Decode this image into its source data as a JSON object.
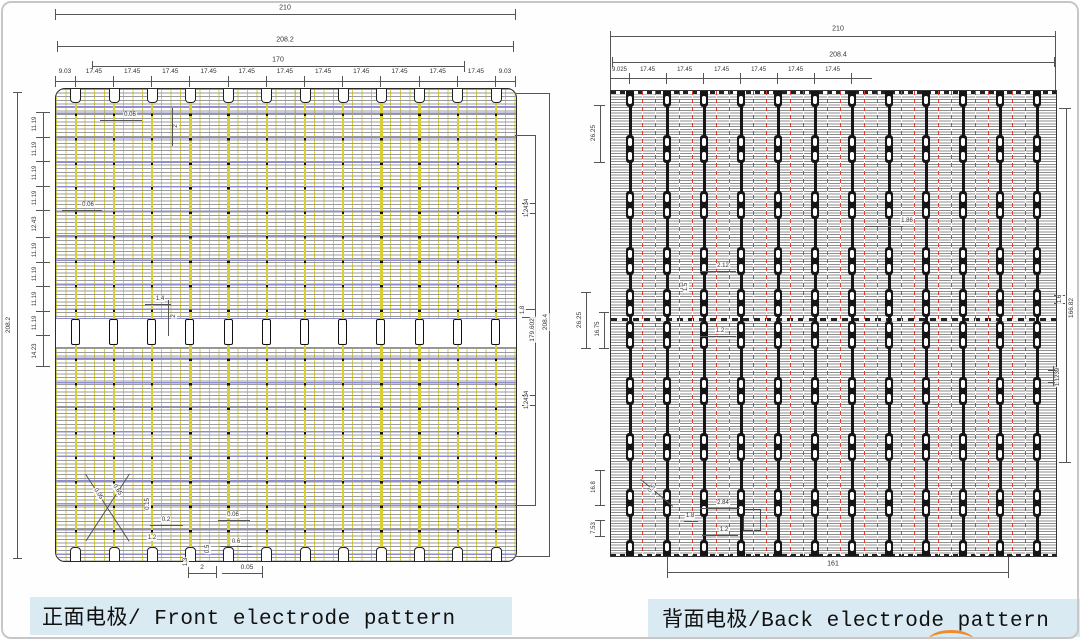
{
  "front": {
    "caption": "正面电极/ Front electrode pattern",
    "overall_width": "210",
    "inner_width": "208.2",
    "busbar_span": "170",
    "segments": [
      "9.03",
      "17.45",
      "17.45",
      "17.45",
      "17.45",
      "17.45",
      "17.45",
      "17.45",
      "17.45",
      "17.45",
      "17.45",
      "17.45",
      "9.03"
    ],
    "height_overall": "208.2",
    "row_chain": [
      "11.19",
      "11.19",
      "11.19",
      "11.19",
      "12.43",
      "11.19",
      "11.19",
      "11.19",
      "11.19",
      "14.23"
    ],
    "right_pad_dim_upper": "1.2434",
    "right_gap_dim": "1.8",
    "right_pad_dim_lower": "1.2434",
    "pad_region_height": "179.602",
    "height_outer": "208.4",
    "finger_width_top": "0.06",
    "finger_width_mid": "0.06",
    "mid_pad_width": "1.4",
    "top_notch_depth": "2",
    "mid_pad_len": "2",
    "bottom_dims": {
      "d015": "0.15",
      "d02": "0.2",
      "d12": "1.2",
      "d05r": "0.5",
      "d006": "0.06",
      "d06": "0.6",
      "d2": "2",
      "d005": "0.05",
      "d13": "1.3",
      "diag1": "0.05",
      "diag2": "0.65"
    }
  },
  "back": {
    "caption": "背面电极/Back electrode pattern",
    "overall_width": "210",
    "inner_width": "208.4",
    "segments": [
      "9.025",
      "17.45",
      "17.45",
      "17.45",
      "17.45",
      "17.45",
      "17.45"
    ],
    "pad_pitch_top": "26.25",
    "pad_pitch_mid": "26.25",
    "pad_gap_mid": "16.75",
    "pad_pitch_bottom": "16.8",
    "edge_gap_bottom": "7.53",
    "right_dims": {
      "d16": "1.6",
      "d16682": "166.82",
      "d11239": "1.1239"
    },
    "bottom_span": "161",
    "interior": {
      "d186": "1.86",
      "d212": "2.12",
      "d15": "1.5",
      "d12a": "1.2",
      "d284": "2.84",
      "d18": "1.8",
      "d12b": "1.2",
      "d05": "0.5"
    }
  },
  "pattern": {
    "front_busbars": 12,
    "back_busbars": 12,
    "back_pad_row_centers": [
      2,
      58,
      114,
      170,
      212,
      244,
      300,
      356,
      412,
      463
    ]
  },
  "colors": {
    "finger_gray": "#9b9b9b",
    "busbar_yellow": "#d9cf30",
    "blue_line": "#8d8dcc",
    "red_centerline": "#e23b2e",
    "caption_bg": "#d9eaf2",
    "stamp_orange": "#ef8b2b"
  }
}
